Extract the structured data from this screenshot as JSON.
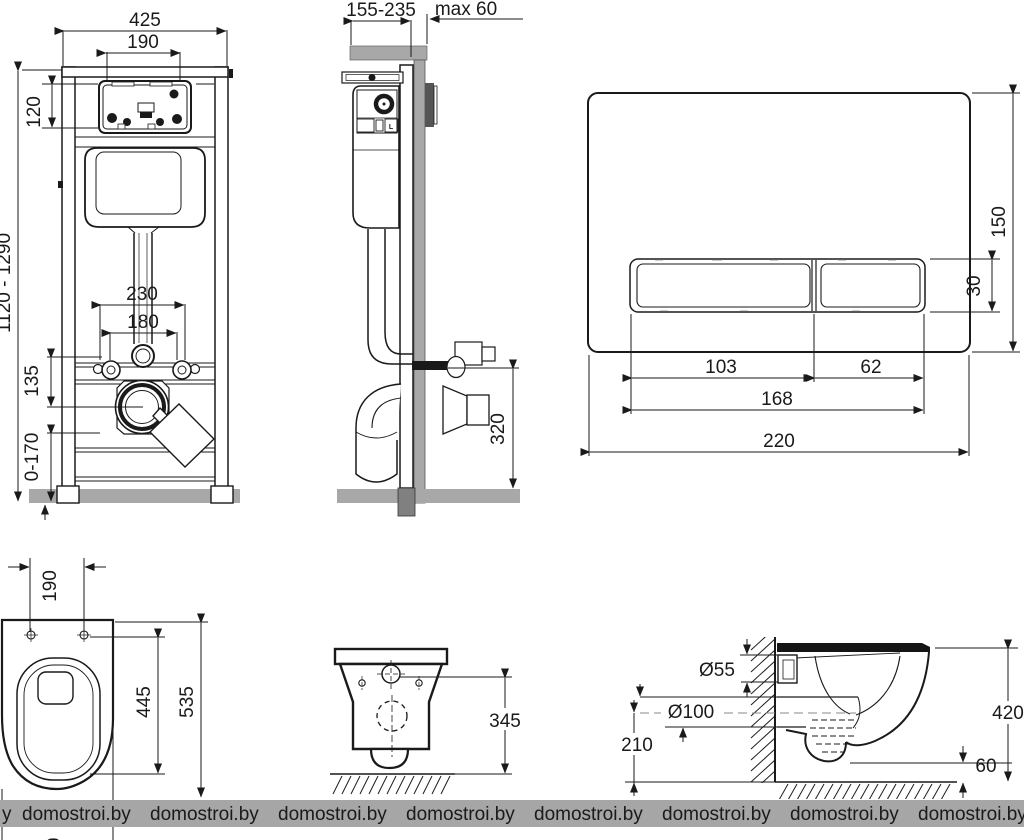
{
  "drawing": {
    "type": "wall-hung toilet installation frame technical drawing",
    "dims": {
      "frame_front": {
        "width": "425",
        "opening_width": "190",
        "opening_height": "120",
        "height_range": "1120 - 1290",
        "anchor_spacing": "230",
        "bolt_spacing": "180",
        "outlet_offset": "135",
        "leg_adjust": "0-170"
      },
      "frame_side": {
        "depth_range": "155-235",
        "wall_max": "max 60",
        "outlet_height": "320",
        "cistern_label": "L"
      },
      "flush_plate": {
        "height": "150",
        "button_height": "30",
        "button1_width": "103",
        "button2_width": "62",
        "buttons_width": "168",
        "width": "220"
      },
      "bowl_top": {
        "hole_spacing": "190",
        "length_to_holes": "445",
        "total_length": "535",
        "partial_digit": "0"
      },
      "bowl_rear": {
        "rim_height": "345"
      },
      "bowl_side": {
        "inlet_diameter": "Ø55",
        "outlet_diameter": "Ø100",
        "outlet_center_height": "210",
        "total_height": "420",
        "floor_clearance": "60"
      }
    }
  },
  "watermark": {
    "text": "domostroi.by",
    "lead_fragment": "y",
    "repeats": 8,
    "start_x": 22,
    "step_x": 128
  },
  "colors": {
    "line": "#1a1a1a",
    "gray_fill": "#a8a8a8",
    "dark_fill": "#808080",
    "watermark_bar": "#a6a6a6",
    "watermark_text": "#f2f2f2",
    "background": "#ffffff"
  }
}
